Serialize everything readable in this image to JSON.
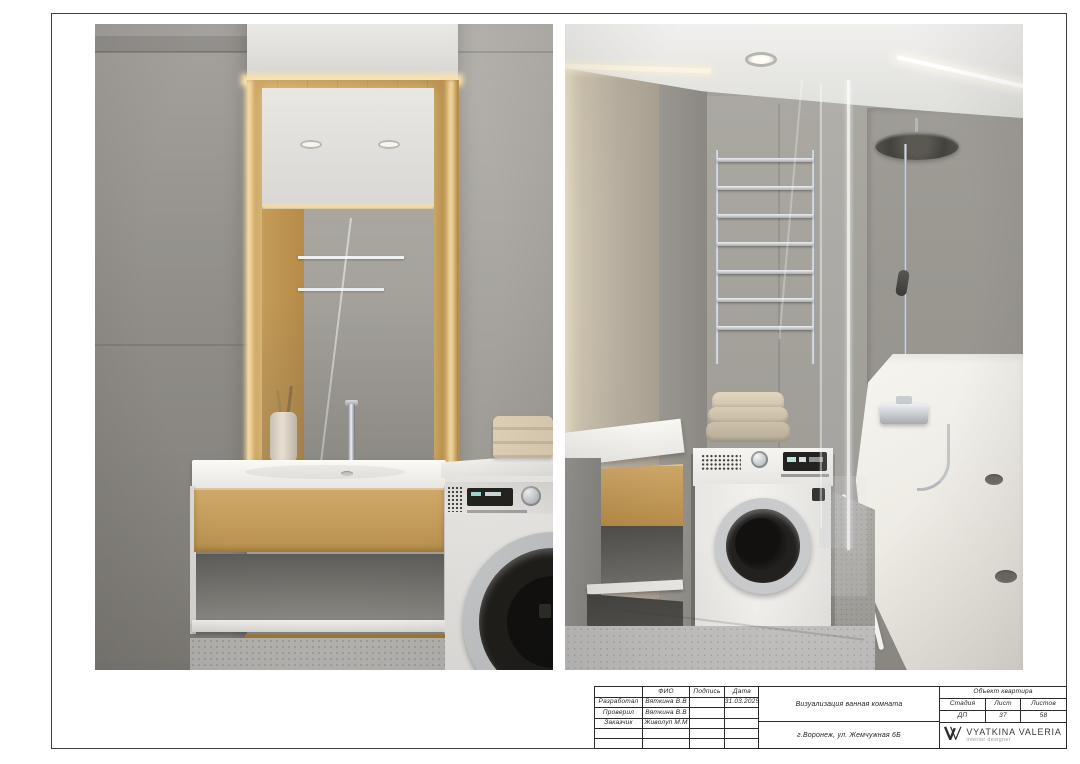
{
  "title_block": {
    "approval": {
      "header": {
        "role": "",
        "fio": "ФИО",
        "signature": "Подпись",
        "date": "Дата"
      },
      "rows": [
        {
          "role": "Разработал",
          "fio": "Вяткина В.В",
          "signature": "",
          "date": "31.03.2025"
        },
        {
          "role": "Проверил",
          "fio": "Вяткина В.В",
          "signature": "",
          "date": ""
        },
        {
          "role": "Заказчик",
          "fio": "Живолуп М.М",
          "signature": "",
          "date": ""
        },
        {
          "role": "",
          "fio": "",
          "signature": "",
          "date": ""
        },
        {
          "role": "",
          "fio": "",
          "signature": "",
          "date": ""
        }
      ]
    },
    "project_title": "Визуализация ванная комната",
    "address": "г.Воронеж, ул. Жемчужная 6Б",
    "object_label": "Объект квартира",
    "sheet_info": {
      "stage_label": "Стадия",
      "sheet_label": "Лист",
      "sheets_label": "Листов",
      "stage": "ДП",
      "sheet": "37",
      "sheets": "58"
    },
    "brand": {
      "name": "VYATKINA VALERIA",
      "tagline": "interior designer",
      "monogram": "W"
    }
  },
  "colors": {
    "page": "#ffffff",
    "frame": "#3f3e3c",
    "stamp_lines": "#2b2b2b",
    "wall_gray": "#a19e98",
    "wood_oak": "#c19553",
    "led_warm_glow": "#f7e3ac",
    "counter_white": "#f3f2ef",
    "chrome": "#c6c8ca",
    "towel_beige": "#d2c6b0",
    "floor_terrazzo": "#bcbbb8",
    "washer_glass": "#1d1c1a"
  }
}
